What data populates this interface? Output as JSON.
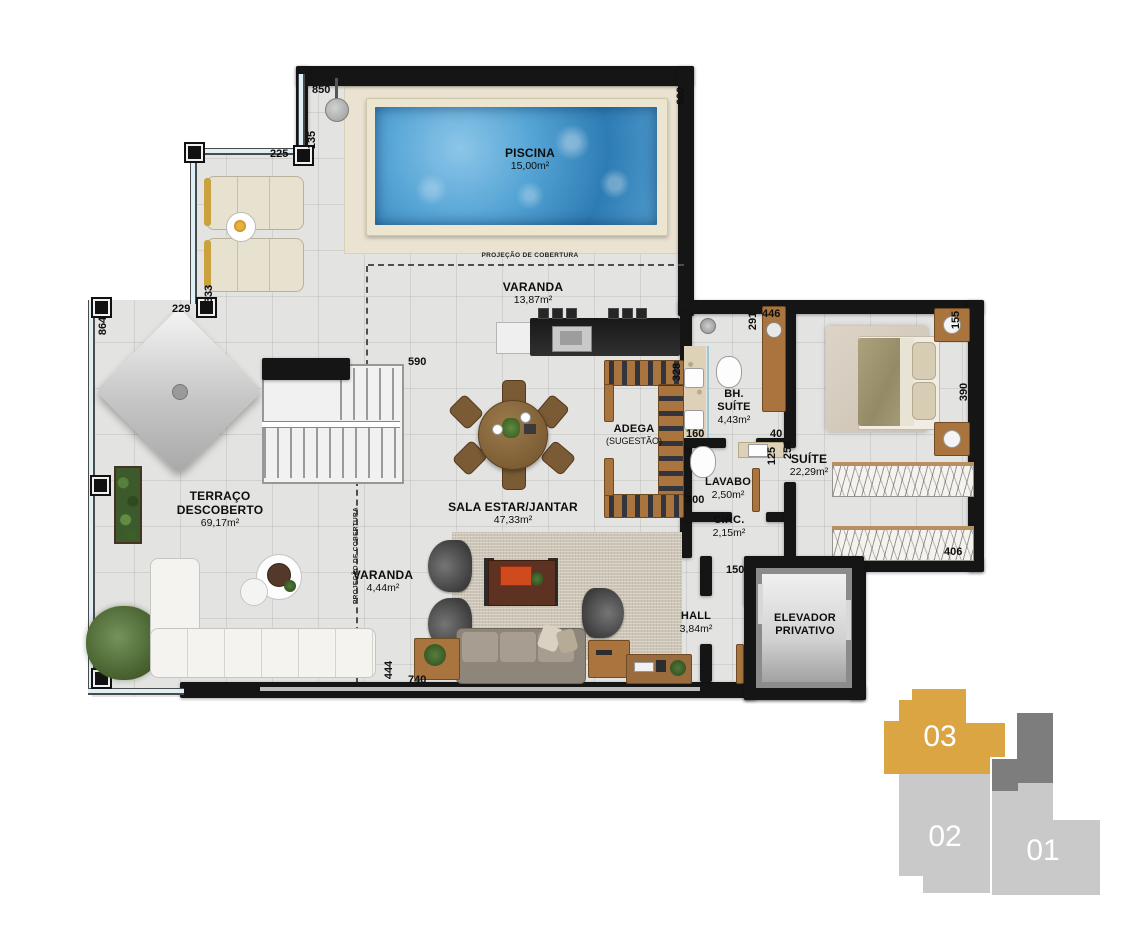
{
  "plan": {
    "rooms": {
      "piscina": {
        "name": "PISCINA",
        "area": "15,00m²"
      },
      "varanda_top": {
        "name": "VARANDA",
        "area": "13,87m²"
      },
      "terraco": {
        "name": "TERRAÇO",
        "name2": "DESCOBERTO",
        "area": "69,17m²"
      },
      "sala": {
        "name": "SALA ESTAR/JANTAR",
        "area": "47,33m²"
      },
      "adega": {
        "name": "ADEGA",
        "area": "(SUGESTÃO)"
      },
      "bh_suite": {
        "name": "BH.",
        "name2": "SUÍTE",
        "area": "4,43m²"
      },
      "lavabo": {
        "name": "LAVABO",
        "area": "2,50m²"
      },
      "suite": {
        "name": "SUÍTE",
        "area": "22,29m²"
      },
      "circ": {
        "name": "CIRC.",
        "area": "2,15m²"
      },
      "hall": {
        "name": "HALL",
        "area": "3,84m²"
      },
      "elevador": {
        "name": "ELEVADOR",
        "name2": "PRIVATIVO"
      },
      "varanda_side": {
        "name": "VARANDA",
        "area": "4,44m²"
      }
    },
    "annotations": {
      "cobertura_top": "PROJEÇÃO DE COBERTURA",
      "cobertura_side": "PROJEÇÃO DE COBERTURA"
    },
    "dimensions": {
      "d850": "850",
      "d600": "600",
      "d135": "135",
      "d225": "225",
      "d333": "333",
      "d229": "229",
      "d864": "864",
      "d590": "590",
      "d328": "328",
      "d291": "291",
      "d446": "446",
      "d155": "155",
      "d390": "390",
      "d160": "160",
      "d40": "40",
      "d125": "125",
      "d254": "254",
      "d200": "200",
      "d406": "406",
      "d150": "150",
      "d740": "740",
      "d444": "444"
    }
  },
  "key_plan": {
    "units": [
      {
        "label": "03",
        "highlighted": true
      },
      {
        "label": "02",
        "highlighted": false
      },
      {
        "label": "01",
        "highlighted": false
      }
    ],
    "colors": {
      "highlight": "#dca544",
      "muted": "#c9c9c9",
      "core": "#7d7d7d"
    }
  }
}
